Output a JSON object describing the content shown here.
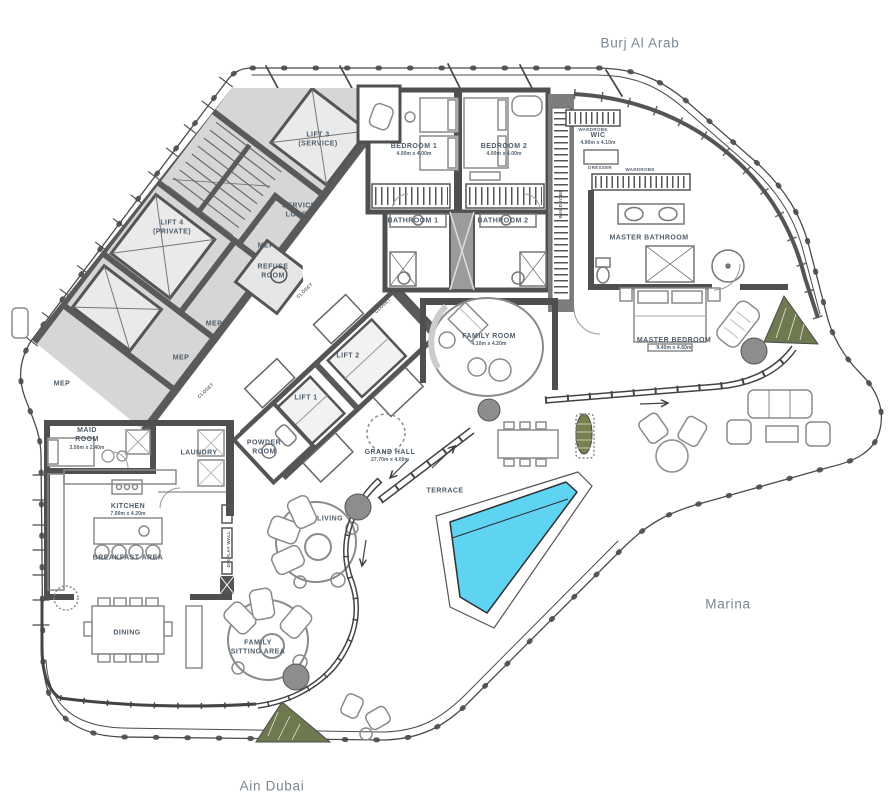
{
  "title": "Penthouse floor plan",
  "context": {
    "top": {
      "label": "Burj Al Arab"
    },
    "right": {
      "label": "Marina"
    },
    "bottom": {
      "label": "Ain Dubai"
    }
  },
  "rooms": [
    {
      "name": "lift-3",
      "lines": [
        "LIFT 3",
        "(SERVICE)"
      ],
      "x": 318,
      "y": 140
    },
    {
      "name": "lift-4",
      "lines": [
        "LIFT 4",
        "(PRIVATE)"
      ],
      "x": 172,
      "y": 228
    },
    {
      "name": "service-lobby",
      "lines": [
        "SERVICE",
        "LOBBY"
      ],
      "x": 299,
      "y": 211
    },
    {
      "name": "mep-1",
      "lines": [
        "MEP"
      ],
      "x": 266,
      "y": 246
    },
    {
      "name": "refuse-room",
      "lines": [
        "REFUSE",
        "ROOM"
      ],
      "x": 273,
      "y": 272
    },
    {
      "name": "mep-2",
      "lines": [
        "MEP"
      ],
      "x": 214,
      "y": 324
    },
    {
      "name": "mep-3",
      "lines": [
        "MEP"
      ],
      "x": 181,
      "y": 358
    },
    {
      "name": "mep-4",
      "lines": [
        "MEP"
      ],
      "x": 62,
      "y": 384
    },
    {
      "name": "bedroom-1",
      "lines": [
        "BEDROOM 1"
      ],
      "dim": "4.00m x 4.00m",
      "x": 414,
      "y": 150
    },
    {
      "name": "bedroom-2",
      "lines": [
        "BEDROOM 2"
      ],
      "dim": "4.00m x 4.00m",
      "x": 504,
      "y": 150
    },
    {
      "name": "bathroom-1",
      "lines": [
        "BATHROOM 1"
      ],
      "x": 413,
      "y": 221
    },
    {
      "name": "bathroom-2",
      "lines": [
        "BATHROOM 2"
      ],
      "x": 503,
      "y": 221
    },
    {
      "name": "wic",
      "lines": [
        "WIC"
      ],
      "dim": "4.90m x 4.10m",
      "x": 598,
      "y": 139
    },
    {
      "name": "master-bathroom",
      "lines": [
        "MASTER BATHROOM"
      ],
      "x": 649,
      "y": 238
    },
    {
      "name": "master-bedroom",
      "lines": [
        "MASTER BEDROOM"
      ],
      "dim": "9.40m x 4.60m",
      "x": 674,
      "y": 344
    },
    {
      "name": "family-room",
      "lines": [
        "FAMILY ROOM"
      ],
      "dim": "4.10m x 4.20m",
      "x": 489,
      "y": 340
    },
    {
      "name": "lift-2",
      "lines": [
        "LIFT 2"
      ],
      "x": 348,
      "y": 356
    },
    {
      "name": "lift-1",
      "lines": [
        "LIFT 1"
      ],
      "x": 306,
      "y": 398
    },
    {
      "name": "powder-room",
      "lines": [
        "POWDER",
        "ROOM"
      ],
      "x": 264,
      "y": 448
    },
    {
      "name": "laundry",
      "lines": [
        "LAUNDRY"
      ],
      "x": 199,
      "y": 453
    },
    {
      "name": "maid-room",
      "lines": [
        "MAID",
        "ROOM"
      ],
      "dim": "3.50m x 2.40m",
      "x": 87,
      "y": 439
    },
    {
      "name": "kitchen",
      "lines": [
        "KITCHEN"
      ],
      "dim": "7.00m x 4.20m",
      "x": 128,
      "y": 510
    },
    {
      "name": "breakfast-area",
      "lines": [
        "BREAKFAST AREA"
      ],
      "x": 128,
      "y": 558
    },
    {
      "name": "grand-hall",
      "lines": [
        "GRAND HALL"
      ],
      "dim": "27.70m x 4.00m",
      "x": 390,
      "y": 456
    },
    {
      "name": "terrace",
      "lines": [
        "TERRACE"
      ],
      "x": 445,
      "y": 491
    },
    {
      "name": "living",
      "lines": [
        "LIVING"
      ],
      "x": 330,
      "y": 519
    },
    {
      "name": "dining",
      "lines": [
        "DINING"
      ],
      "x": 127,
      "y": 633
    },
    {
      "name": "family-sitting-area",
      "lines": [
        "FAMILY",
        "SITTING AREA"
      ],
      "x": 258,
      "y": 648
    },
    {
      "name": "display-wall",
      "lines": [
        "DISPLAY WALL"
      ],
      "x": 229,
      "y": 549,
      "rot": -90,
      "small": true
    },
    {
      "name": "wardrobe-top",
      "lines": [
        "WARDROBE"
      ],
      "x": 593,
      "y": 130,
      "small": true
    },
    {
      "name": "wardrobe-right",
      "lines": [
        "WARDROBE"
      ],
      "x": 640,
      "y": 170,
      "small": true
    },
    {
      "name": "wardrobe-corridor",
      "lines": [
        "WARDROBE"
      ],
      "x": 561,
      "y": 204,
      "rot": -90,
      "small": true
    },
    {
      "name": "dresser",
      "lines": [
        "DRESSER"
      ],
      "x": 600,
      "y": 168,
      "small": true
    },
    {
      "name": "closet-1",
      "lines": [
        "CLOSET"
      ],
      "x": 305,
      "y": 291,
      "rot": -43,
      "small": true
    },
    {
      "name": "closet-2",
      "lines": [
        "CLOSET"
      ],
      "x": 383,
      "y": 306,
      "rot": -43,
      "small": true
    },
    {
      "name": "closet-3",
      "lines": [
        "CLOSET"
      ],
      "x": 206,
      "y": 391,
      "rot": -43,
      "small": true
    }
  ],
  "colors": {
    "pool": "#5ed3f2",
    "walls": "#4f4f4f",
    "service_core_fill": "#d6d6d6",
    "room_label": "#4e5d6b",
    "context_label": "#7b8691",
    "hedge": "#6e7950",
    "planter": "#8d8d8d"
  }
}
